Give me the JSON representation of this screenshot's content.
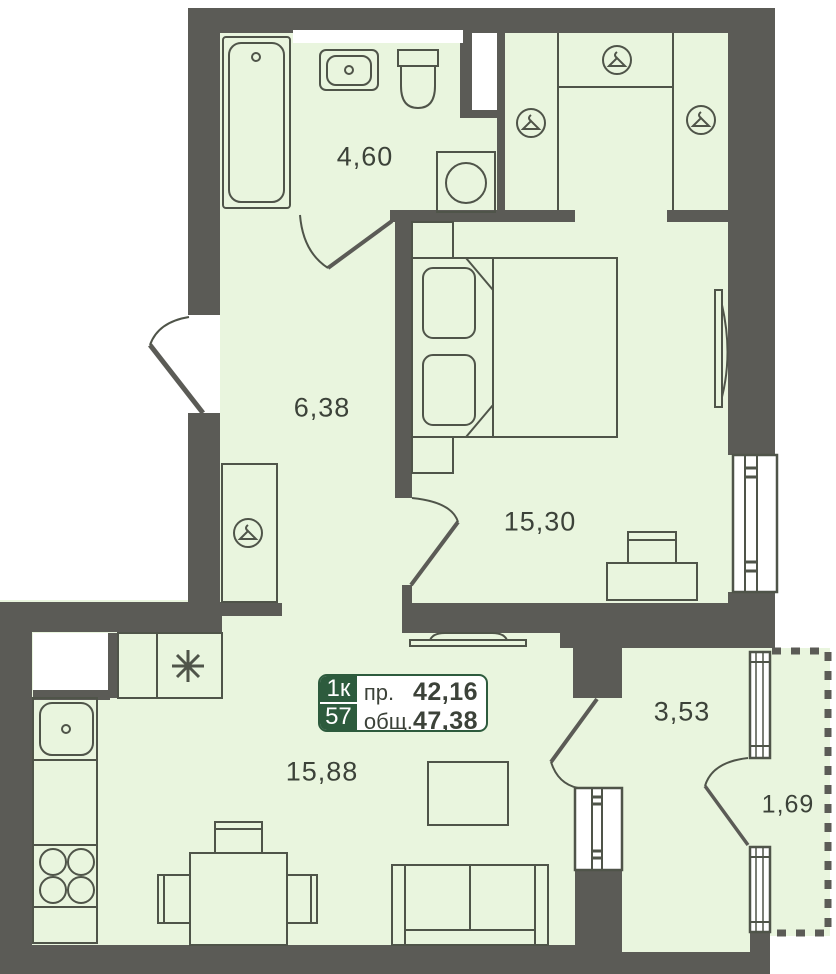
{
  "plan": {
    "title": "1-room apartment floor plan",
    "rooms": [
      {
        "id": "bathroom",
        "area": "4,60"
      },
      {
        "id": "hallway",
        "area": "6,38"
      },
      {
        "id": "bedroom",
        "area": "15,30"
      },
      {
        "id": "living-kitchen",
        "area": "15,88"
      },
      {
        "id": "loggia",
        "area": "3,53"
      },
      {
        "id": "balcony",
        "area": "1,69"
      }
    ],
    "badge": {
      "rooms_count": "1к",
      "unit_number": "57",
      "reduced_label": "пр.",
      "reduced_area": "42,16",
      "total_label": "общ.",
      "total_area": "47,38"
    },
    "icons": [
      "hanger-icon",
      "snowflake-fridge-icon",
      "stove-burners-icon",
      "sink-drain-icon"
    ],
    "colors": {
      "floor": "#e9f5de",
      "wall": "#5b5b56",
      "furniture_line": "#4f5449",
      "badge_green": "#2d5b3d",
      "outside": "#ffffff"
    }
  }
}
